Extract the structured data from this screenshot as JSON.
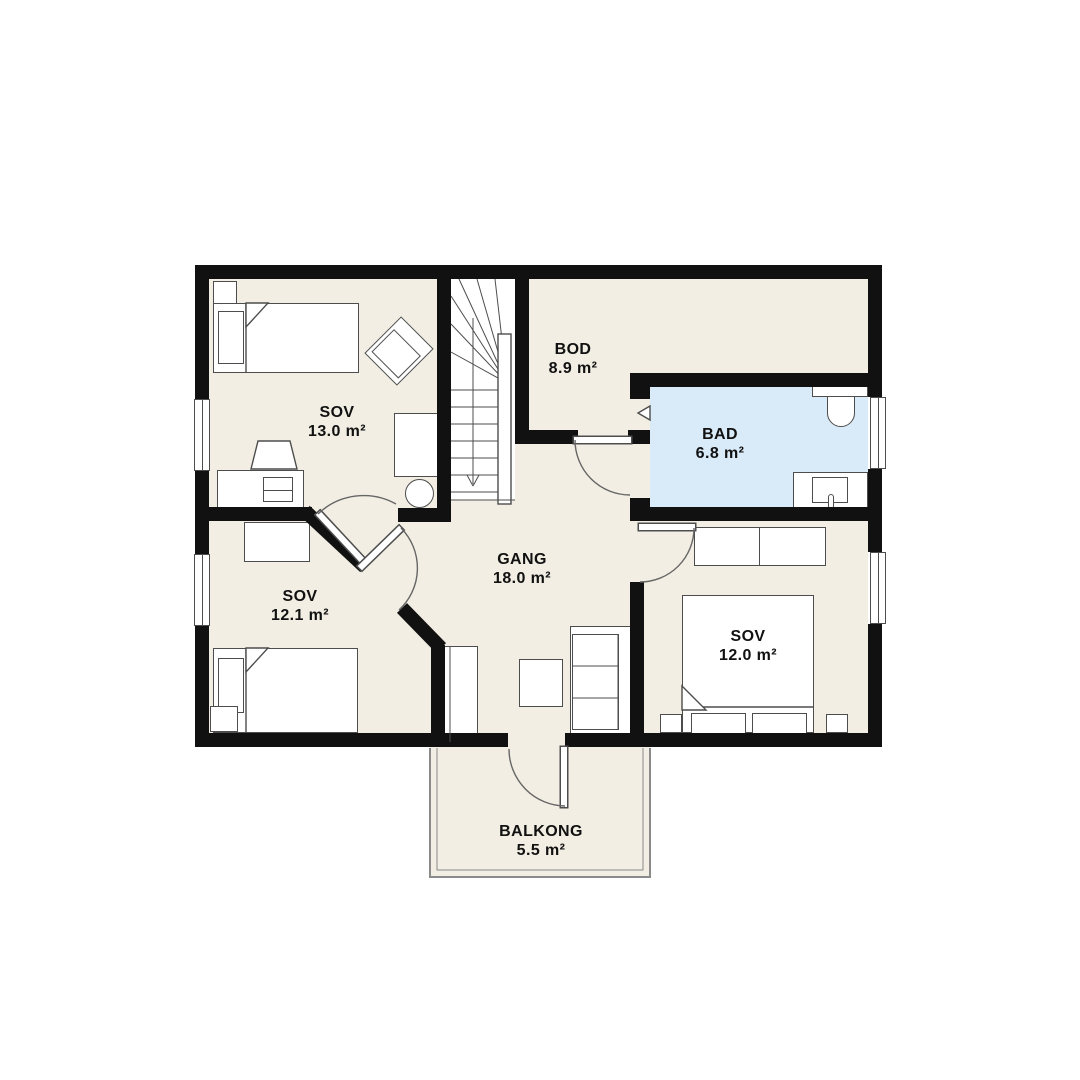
{
  "plan": {
    "title": "floor-plan",
    "colors": {
      "floor": "#f2eee3",
      "wall": "#111111",
      "bath": "#d9eaf8",
      "outline": "#4d4d4d",
      "arc": "#666666",
      "text": "#111111",
      "bg": "#ffffff",
      "railing": "#8a8a8a"
    },
    "rooms": [
      {
        "id": "sov-13",
        "name": "SOV",
        "area": "13.0 m²"
      },
      {
        "id": "bod",
        "name": "BOD",
        "area": "8.9 m²"
      },
      {
        "id": "bad",
        "name": "BAD",
        "area": "6.8 m²"
      },
      {
        "id": "gang",
        "name": "GANG",
        "area": "18.0 m²"
      },
      {
        "id": "sov-12-1",
        "name": "SOV",
        "area": "12.1 m²"
      },
      {
        "id": "sov-12-0",
        "name": "SOV",
        "area": "12.0 m²"
      },
      {
        "id": "balkong",
        "name": "BALKONG",
        "area": "5.5 m²"
      }
    ]
  }
}
